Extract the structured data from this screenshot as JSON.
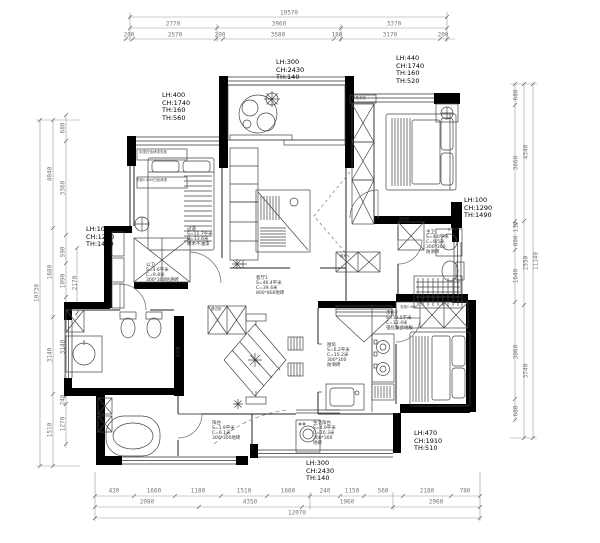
{
  "drawing": {
    "kind": "residential floor plan (CAD)",
    "colors": {
      "wall": "#000000",
      "line": "#3c3c3c",
      "dim": "#777777",
      "paper": "#ffffff"
    },
    "overall": {
      "top_total": "10570",
      "bottom_total": "12070",
      "left_total": "10730",
      "right_total": "11140"
    },
    "rooms": [
      {
        "name": "客厅1",
        "area": "S=46.4平米",
        "perimeter": "C=39.4米",
        "floor": "800*800地砖"
      },
      {
        "name": "厨房",
        "area": "S=6.2平米",
        "perimeter": "C=10.2米",
        "floor": "300*300防滑砖"
      },
      {
        "name": "生活阳台",
        "area": "S=4.9平米",
        "perimeter": "C=10.3米",
        "floor": "300*300地砖"
      },
      {
        "name": "主卫",
        "area": "S=4.0平米",
        "perimeter": "C=9.5米",
        "floor": "300*300防滑砖"
      },
      {
        "name": "公卫",
        "area": "S=4.6平米",
        "perimeter": "C=9.8米",
        "floor": "300*300防滑砖"
      },
      {
        "name": "过道",
        "area": "S=11.7平米",
        "perimeter": "C=13.6米",
        "floor": "橡木不油漆"
      },
      {
        "name": "次卧2",
        "area": "S=10.5平米",
        "perimeter": "C=13.4米",
        "floor": "强化复合地板"
      }
    ]
  },
  "labels": [
    {
      "name": "dim-top-total",
      "text": "10570",
      "x": 289,
      "y": 13,
      "size": 6,
      "cls": "dim",
      "align": "center"
    },
    {
      "name": "dim-top",
      "text": "2770",
      "x": 173,
      "y": 24,
      "size": 6,
      "cls": "dim",
      "align": "center"
    },
    {
      "name": "dim-top",
      "text": "3960",
      "x": 279,
      "y": 24,
      "size": 6,
      "cls": "dim",
      "align": "center"
    },
    {
      "name": "dim-top",
      "text": "3370",
      "x": 394,
      "y": 24,
      "size": 6,
      "cls": "dim",
      "align": "center"
    },
    {
      "name": "dim-top",
      "text": "200",
      "x": 129,
      "y": 35,
      "size": 6,
      "cls": "dim",
      "align": "center"
    },
    {
      "name": "dim-top",
      "text": "2570",
      "x": 175,
      "y": 35,
      "size": 6,
      "cls": "dim",
      "align": "center"
    },
    {
      "name": "dim-top",
      "text": "200",
      "x": 220,
      "y": 35,
      "size": 6,
      "cls": "dim",
      "align": "center"
    },
    {
      "name": "dim-top",
      "text": "3580",
      "x": 278,
      "y": 35,
      "size": 6,
      "cls": "dim",
      "align": "center"
    },
    {
      "name": "dim-top",
      "text": "180",
      "x": 337,
      "y": 35,
      "size": 6,
      "cls": "dim",
      "align": "center"
    },
    {
      "name": "dim-top",
      "text": "3170",
      "x": 390,
      "y": 35,
      "size": 6,
      "cls": "dim",
      "align": "center"
    },
    {
      "name": "dim-top",
      "text": "200",
      "x": 443,
      "y": 35,
      "size": 6,
      "cls": "dim",
      "align": "center"
    },
    {
      "name": "dim-bottom",
      "text": "420",
      "x": 114,
      "y": 491,
      "size": 6,
      "cls": "dim",
      "align": "center"
    },
    {
      "name": "dim-bottom",
      "text": "1660",
      "x": 154,
      "y": 491,
      "size": 6,
      "cls": "dim",
      "align": "center"
    },
    {
      "name": "dim-bottom",
      "text": "1180",
      "x": 198,
      "y": 491,
      "size": 6,
      "cls": "dim",
      "align": "center"
    },
    {
      "name": "dim-bottom",
      "text": "1510",
      "x": 244,
      "y": 491,
      "size": 6,
      "cls": "dim",
      "align": "center"
    },
    {
      "name": "dim-bottom",
      "text": "1660",
      "x": 288,
      "y": 491,
      "size": 6,
      "cls": "dim",
      "align": "center"
    },
    {
      "name": "dim-bottom",
      "text": "240",
      "x": 325,
      "y": 491,
      "size": 6,
      "cls": "dim",
      "align": "center"
    },
    {
      "name": "dim-bottom",
      "text": "1150",
      "x": 352,
      "y": 491,
      "size": 6,
      "cls": "dim",
      "align": "center"
    },
    {
      "name": "dim-bottom",
      "text": "560",
      "x": 383,
      "y": 491,
      "size": 6,
      "cls": "dim",
      "align": "center"
    },
    {
      "name": "dim-bottom",
      "text": "2180",
      "x": 427,
      "y": 491,
      "size": 6,
      "cls": "dim",
      "align": "center"
    },
    {
      "name": "dim-bottom",
      "text": "780",
      "x": 465,
      "y": 491,
      "size": 6,
      "cls": "dim",
      "align": "center"
    },
    {
      "name": "dim-bottom",
      "text": "2080",
      "x": 147,
      "y": 502,
      "size": 6,
      "cls": "dim",
      "align": "center"
    },
    {
      "name": "dim-bottom",
      "text": "4350",
      "x": 250,
      "y": 502,
      "size": 6,
      "cls": "dim",
      "align": "center"
    },
    {
      "name": "dim-bottom",
      "text": "1960",
      "x": 347,
      "y": 502,
      "size": 6,
      "cls": "dim",
      "align": "center"
    },
    {
      "name": "dim-bottom",
      "text": "2960",
      "x": 436,
      "y": 502,
      "size": 6,
      "cls": "dim",
      "align": "center"
    },
    {
      "name": "dim-bottom-total",
      "text": "12070",
      "x": 297,
      "y": 513,
      "size": 6,
      "cls": "dim",
      "align": "center"
    },
    {
      "name": "dim-left-total",
      "text": "10730",
      "x": 37,
      "y": 293,
      "size": 6,
      "cls": "dim",
      "rot": -90
    },
    {
      "name": "dim-left",
      "text": "4040",
      "x": 50,
      "y": 174,
      "size": 6,
      "cls": "dim",
      "rot": -90
    },
    {
      "name": "dim-left",
      "text": "1680",
      "x": 50,
      "y": 272,
      "size": 6,
      "cls": "dim",
      "rot": -90
    },
    {
      "name": "dim-left",
      "text": "3140",
      "x": 50,
      "y": 355,
      "size": 6,
      "cls": "dim",
      "rot": -90
    },
    {
      "name": "dim-left",
      "text": "1510",
      "x": 50,
      "y": 430,
      "size": 6,
      "cls": "dim",
      "rot": -90
    },
    {
      "name": "dim-left",
      "text": "680",
      "x": 63,
      "y": 128,
      "size": 6,
      "cls": "dim",
      "rot": -90
    },
    {
      "name": "dim-left",
      "text": "3360",
      "x": 63,
      "y": 188,
      "size": 6,
      "cls": "dim",
      "rot": -90
    },
    {
      "name": "dim-left",
      "text": "590",
      "x": 63,
      "y": 252,
      "size": 6,
      "cls": "dim",
      "rot": -90
    },
    {
      "name": "dim-left",
      "text": "1090",
      "x": 63,
      "y": 281,
      "size": 6,
      "cls": "dim",
      "rot": -90
    },
    {
      "name": "dim-left",
      "text": "3140",
      "x": 63,
      "y": 347,
      "size": 6,
      "cls": "dim",
      "rot": -90
    },
    {
      "name": "dim-left",
      "text": "240",
      "x": 63,
      "y": 400,
      "size": 6,
      "cls": "dim",
      "rot": -90
    },
    {
      "name": "dim-left",
      "text": "1270",
      "x": 63,
      "y": 424,
      "size": 6,
      "cls": "dim",
      "rot": -90
    },
    {
      "name": "dim-left",
      "text": "2170",
      "x": 75,
      "y": 283,
      "size": 6,
      "cls": "dim",
      "rot": -90
    },
    {
      "name": "dim-right-total",
      "text": "11140",
      "x": 536,
      "y": 261,
      "size": 6,
      "cls": "dim",
      "rot": -90
    },
    {
      "name": "dim-right",
      "text": "4340",
      "x": 526,
      "y": 152,
      "size": 6,
      "cls": "dim",
      "rot": -90
    },
    {
      "name": "dim-right",
      "text": "2550",
      "x": 526,
      "y": 263,
      "size": 6,
      "cls": "dim",
      "rot": -90
    },
    {
      "name": "dim-right",
      "text": "3740",
      "x": 526,
      "y": 371,
      "size": 6,
      "cls": "dim",
      "rot": -90
    },
    {
      "name": "dim-right",
      "text": "680",
      "x": 516,
      "y": 95,
      "size": 6,
      "cls": "dim",
      "rot": -90
    },
    {
      "name": "dim-right",
      "text": "3660",
      "x": 516,
      "y": 163,
      "size": 6,
      "cls": "dim",
      "rot": -90
    },
    {
      "name": "dim-right",
      "text": "110",
      "x": 516,
      "y": 227,
      "size": 6,
      "cls": "dim",
      "rot": -90
    },
    {
      "name": "dim-right",
      "text": "800",
      "x": 516,
      "y": 241,
      "size": 6,
      "cls": "dim",
      "rot": -90
    },
    {
      "name": "dim-right",
      "text": "1640",
      "x": 516,
      "y": 276,
      "size": 6,
      "cls": "dim",
      "rot": -90
    },
    {
      "name": "dim-right",
      "text": "3060",
      "x": 516,
      "y": 352,
      "size": 6,
      "cls": "dim",
      "rot": -90
    },
    {
      "name": "dim-right",
      "text": "680",
      "x": 516,
      "y": 411,
      "size": 6,
      "cls": "dim",
      "rot": -90
    },
    {
      "name": "annotation-top-left",
      "text": "LH:400\nCH:1740\nTH:160\nTH:560",
      "x": 162,
      "y": 92,
      "size": 6.5,
      "cls": "ann"
    },
    {
      "name": "annotation-top-center",
      "text": "LH:300\nCH:2430\nTH:140",
      "x": 276,
      "y": 59,
      "size": 6.5,
      "cls": "ann"
    },
    {
      "name": "annotation-top-right",
      "text": "LH:440\nCH:1740\nTH:160\nTH:520",
      "x": 396,
      "y": 55,
      "size": 6.5,
      "cls": "ann"
    },
    {
      "name": "annotation-left",
      "text": "LH:100\nCH:1290\nTH:1490",
      "x": 86,
      "y": 226,
      "size": 6.5,
      "cls": "ann"
    },
    {
      "name": "annotation-right",
      "text": "LH:100\nCH:1290\nTH:1490",
      "x": 464,
      "y": 197,
      "size": 6.5,
      "cls": "ann"
    },
    {
      "name": "annotation-bottom-right",
      "text": "LH:470\nCH:1910\nTH:510",
      "x": 414,
      "y": 430,
      "size": 6.5,
      "cls": "ann"
    },
    {
      "name": "annotation-bottom-center",
      "text": "LH:300\nCH:2430\nTH:140",
      "x": 306,
      "y": 460,
      "size": 6.5,
      "cls": "ann"
    },
    {
      "name": "room-living",
      "text": "客厅1\nS=46.4平米\nC=39.4米\n800*800地砖",
      "x": 256,
      "y": 276,
      "size": 4.5,
      "cls": "room"
    },
    {
      "name": "room-kitchen",
      "text": "厨房\nS=6.2平米\nC=10.2米\n300*300\n防滑砖",
      "x": 327,
      "y": 343,
      "size": 4.5,
      "cls": "room"
    },
    {
      "name": "room-balcony",
      "text": "生活阳台\nS=4.9平米\nC=10.3米\n300*300\n地砖",
      "x": 313,
      "y": 421,
      "size": 4.5,
      "cls": "room"
    },
    {
      "name": "room-bath-master",
      "text": "主卫\nS=4.0平米\nC=9.5米\n300*300\n防滑砖",
      "x": 426,
      "y": 230,
      "size": 4.5,
      "cls": "room"
    },
    {
      "name": "room-hall",
      "text": "过道\nS=11.7平米\nC=13.6米\n橡木不油漆",
      "x": 187,
      "y": 227,
      "size": 4.5,
      "cls": "room"
    },
    {
      "name": "room-bath-guest",
      "text": "公卫\nS=4.6平米\nC=9.8米\n300*300防滑砖",
      "x": 146,
      "y": 263,
      "size": 4.5,
      "cls": "room"
    },
    {
      "name": "room-bedroom2",
      "text": "次卧2\nS=10.5平米\nC=13.4米\n强化复合地板",
      "x": 386,
      "y": 311,
      "size": 4.5,
      "cls": "room"
    },
    {
      "name": "room-balcony-small",
      "text": "阳台\nS=1.9平米\nC=6.1米\n300*300地砖",
      "x": 212,
      "y": 421,
      "size": 4.5,
      "cls": "room"
    },
    {
      "name": "cab-wardrobe-top",
      "text": "到顶白色烤漆衣柜",
      "x": 139,
      "y": 151,
      "size": 3.5,
      "cls": "tiny"
    },
    {
      "name": "cab-bookcase",
      "text": "书柜C:600白色烤漆",
      "x": 136,
      "y": 179,
      "size": 3.5,
      "cls": "tiny"
    },
    {
      "name": "cab-pipe",
      "text": "包立管",
      "x": 179,
      "y": 352,
      "size": 3.5,
      "cls": "tiny",
      "rot": -90
    },
    {
      "name": "cab-corner-wardrobe",
      "text": "转角衣柜",
      "x": 352,
      "y": 97,
      "size": 3.5,
      "cls": "tiny"
    },
    {
      "name": "cab-sideboard",
      "text": "餐边柜",
      "x": 211,
      "y": 308,
      "size": 3.5,
      "cls": "tiny"
    },
    {
      "name": "cab-washer",
      "text": "洗衣机",
      "x": 399,
      "y": 218,
      "size": 3.5,
      "cls": "tiny"
    },
    {
      "name": "cab-wardrobe2",
      "text": "衣柜C:600",
      "x": 400,
      "y": 306,
      "size": 3.5,
      "cls": "tiny"
    },
    {
      "name": "cab-shoe",
      "text": "鞋柜",
      "x": 340,
      "y": 255,
      "size": 3.5,
      "cls": "tiny"
    }
  ]
}
